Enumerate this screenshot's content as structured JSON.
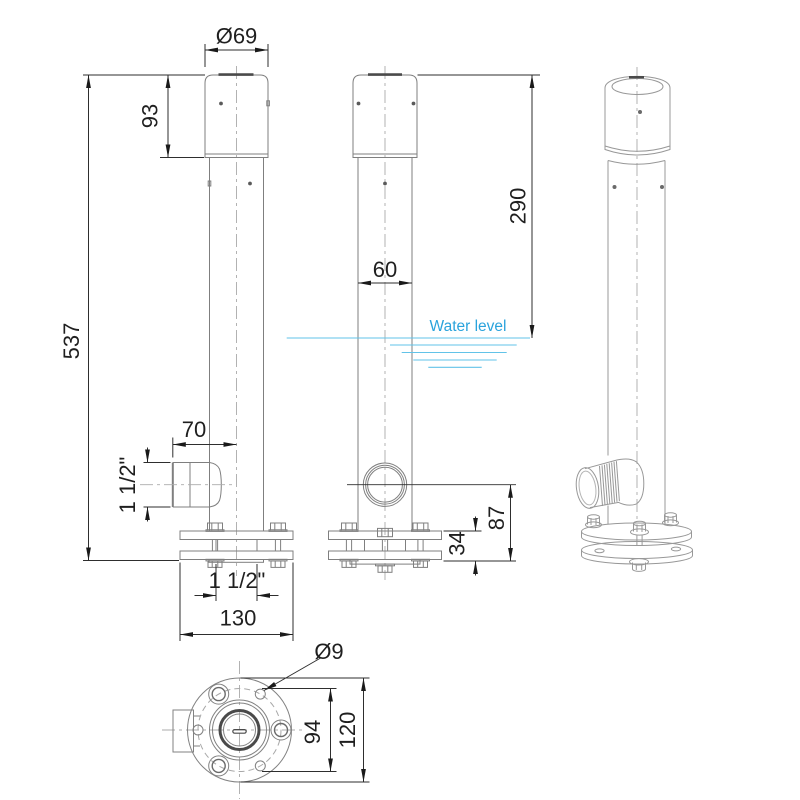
{
  "drawing": {
    "dimensions": {
      "cap_diameter": "Ø69",
      "cap_height": "93",
      "total_height": "537",
      "top_to_water": "290",
      "tube_diameter": "60",
      "outlet_projection": "70",
      "outlet_thread": "1 1/2\"",
      "base_thread": "1 1/2\"",
      "flange_width": "130",
      "outlet_height": "87",
      "flange_stack_height": "34",
      "hole_diameter": "Ø9",
      "bolt_circle": "94",
      "base_diameter": "120"
    },
    "annotations": {
      "water_level": "Water level"
    },
    "colors": {
      "outline": "#7f7f7f",
      "dimension": "#2e2e2e",
      "water": "#2aa3dc",
      "background": "#ffffff"
    }
  }
}
